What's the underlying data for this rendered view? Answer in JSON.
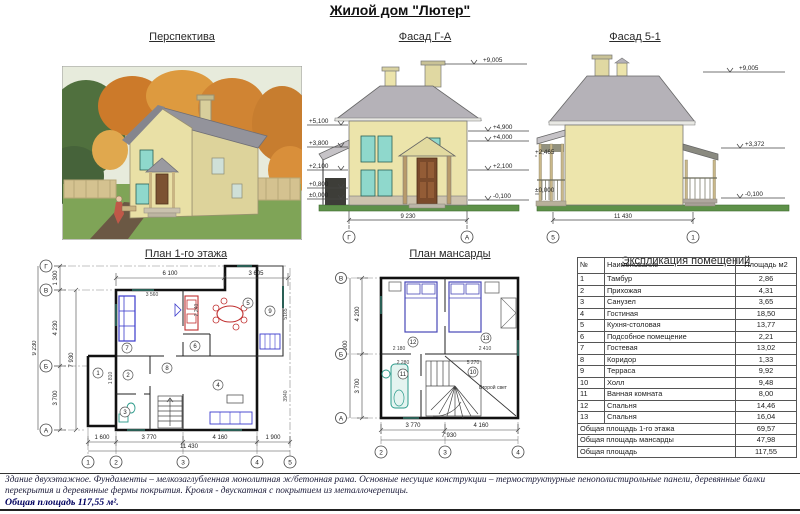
{
  "title": "Жилой дом \"Лютер\"",
  "perspective": {
    "title": "Перспектива"
  },
  "facade_ga": {
    "title": "Фасад Г-А",
    "mark_top": "+9,005",
    "marks_left": [
      "+5,100",
      "+3,800",
      "+2,100",
      "+0,800",
      "±0,000"
    ],
    "marks_right": [
      "+4,900",
      "+4,000",
      "+2,100",
      "-0,100"
    ],
    "dim": "9 230",
    "axis_left": "Г",
    "axis_right": "А"
  },
  "facade_51": {
    "title": "Фасад 5-1",
    "mark_top": "+9,005",
    "marks_left": [
      "+2,465",
      "±0,000"
    ],
    "marks_right": [
      "+3,372",
      "-0,100"
    ],
    "dim": "11 430",
    "axis_left": "5",
    "axis_right": "1"
  },
  "plan1": {
    "title": "План 1-го этажа",
    "dims_top": [
      "6 100",
      "3 605"
    ],
    "dims_bottom": [
      "1 600",
      "3 770",
      "4 160",
      "1 900"
    ],
    "dim_bottom_total": "11 430",
    "dims_left": [
      "1 300",
      "4 230",
      "3 700"
    ],
    "dim_left_total": "9 230",
    "dim_left_inner": "7 930",
    "dims_right": [
      "5165",
      "3940"
    ],
    "dims_inner": [
      "3 560",
      "2 240",
      "1 810"
    ],
    "axes_bottom": [
      "1",
      "2",
      "3",
      "4",
      "5"
    ],
    "axes_left": [
      "Г",
      "В",
      "Б",
      "А"
    ],
    "rooms": [
      "1",
      "2",
      "3",
      "4",
      "5",
      "6",
      "7",
      "8",
      "9"
    ]
  },
  "plan_m": {
    "title": "План мансарды",
    "dims_bottom": [
      "3 770",
      "4 160"
    ],
    "dim_bottom_total": "7 930",
    "dims_left": [
      "4 200",
      "3 700"
    ],
    "dim_left_total": "7 900",
    "dims_inner": [
      "2 180",
      "2 410",
      "2 280",
      "5 270"
    ],
    "axes_bottom": [
      "2",
      "3",
      "4"
    ],
    "axes_left": [
      "В",
      "Б",
      "А"
    ],
    "rooms": [
      "10",
      "11",
      "12",
      "13"
    ],
    "note": "Второй свет"
  },
  "table": {
    "title": "Экспликация помещений",
    "col_num": "№",
    "col_name": "Наименование",
    "col_area": "Площадь м2",
    "rows": [
      {
        "n": "1",
        "name": "Тамбур",
        "area": "2,86"
      },
      {
        "n": "2",
        "name": "Прихожая",
        "area": "4,31"
      },
      {
        "n": "3",
        "name": "Санузел",
        "area": "3,65"
      },
      {
        "n": "4",
        "name": "Гостиная",
        "area": "18,50"
      },
      {
        "n": "5",
        "name": "Кухня-столовая",
        "area": "13,77"
      },
      {
        "n": "6",
        "name": "Подсобное помещение",
        "area": "2,21"
      },
      {
        "n": "7",
        "name": "Гостевая",
        "area": "13,02"
      },
      {
        "n": "8",
        "name": "Коридор",
        "area": "1,33"
      },
      {
        "n": "9",
        "name": "Терраса",
        "area": "9,92"
      },
      {
        "n": "10",
        "name": "Холл",
        "area": "9,48"
      },
      {
        "n": "11",
        "name": "Ванная комната",
        "area": "8,00"
      },
      {
        "n": "12",
        "name": "Спальня",
        "area": "14,46"
      },
      {
        "n": "13",
        "name": "Спальня",
        "area": "16,04"
      }
    ],
    "totals": [
      {
        "name": "Общая площадь 1-го этажа",
        "area": "69,57"
      },
      {
        "name": "Общая площадь мансарды",
        "area": "47,98"
      },
      {
        "name": "Общая площадь",
        "area": "117,55"
      }
    ]
  },
  "footer": {
    "text1": "Здание двухэтажное. Фундаменты – мелкозаглубленная монолитная ж/бетонная рама. Основные несущие конструкции – термоструктурные пенополистирольные панели, деревянные балки",
    "text2": "перекрытия и деревянные фермы покрытия. Кровля - двускатная с покрытием из металлочерепицы.",
    "total": "Общая площадь 117,55 м²."
  },
  "colors": {
    "wall": "#ECE4AB",
    "roof": "#B5B2B8",
    "grass": "#5E9149",
    "window_teal": "#8FD8CC",
    "furniture_red": "#C03030",
    "furniture_blue": "#3A3ACC",
    "line": "#333333"
  }
}
